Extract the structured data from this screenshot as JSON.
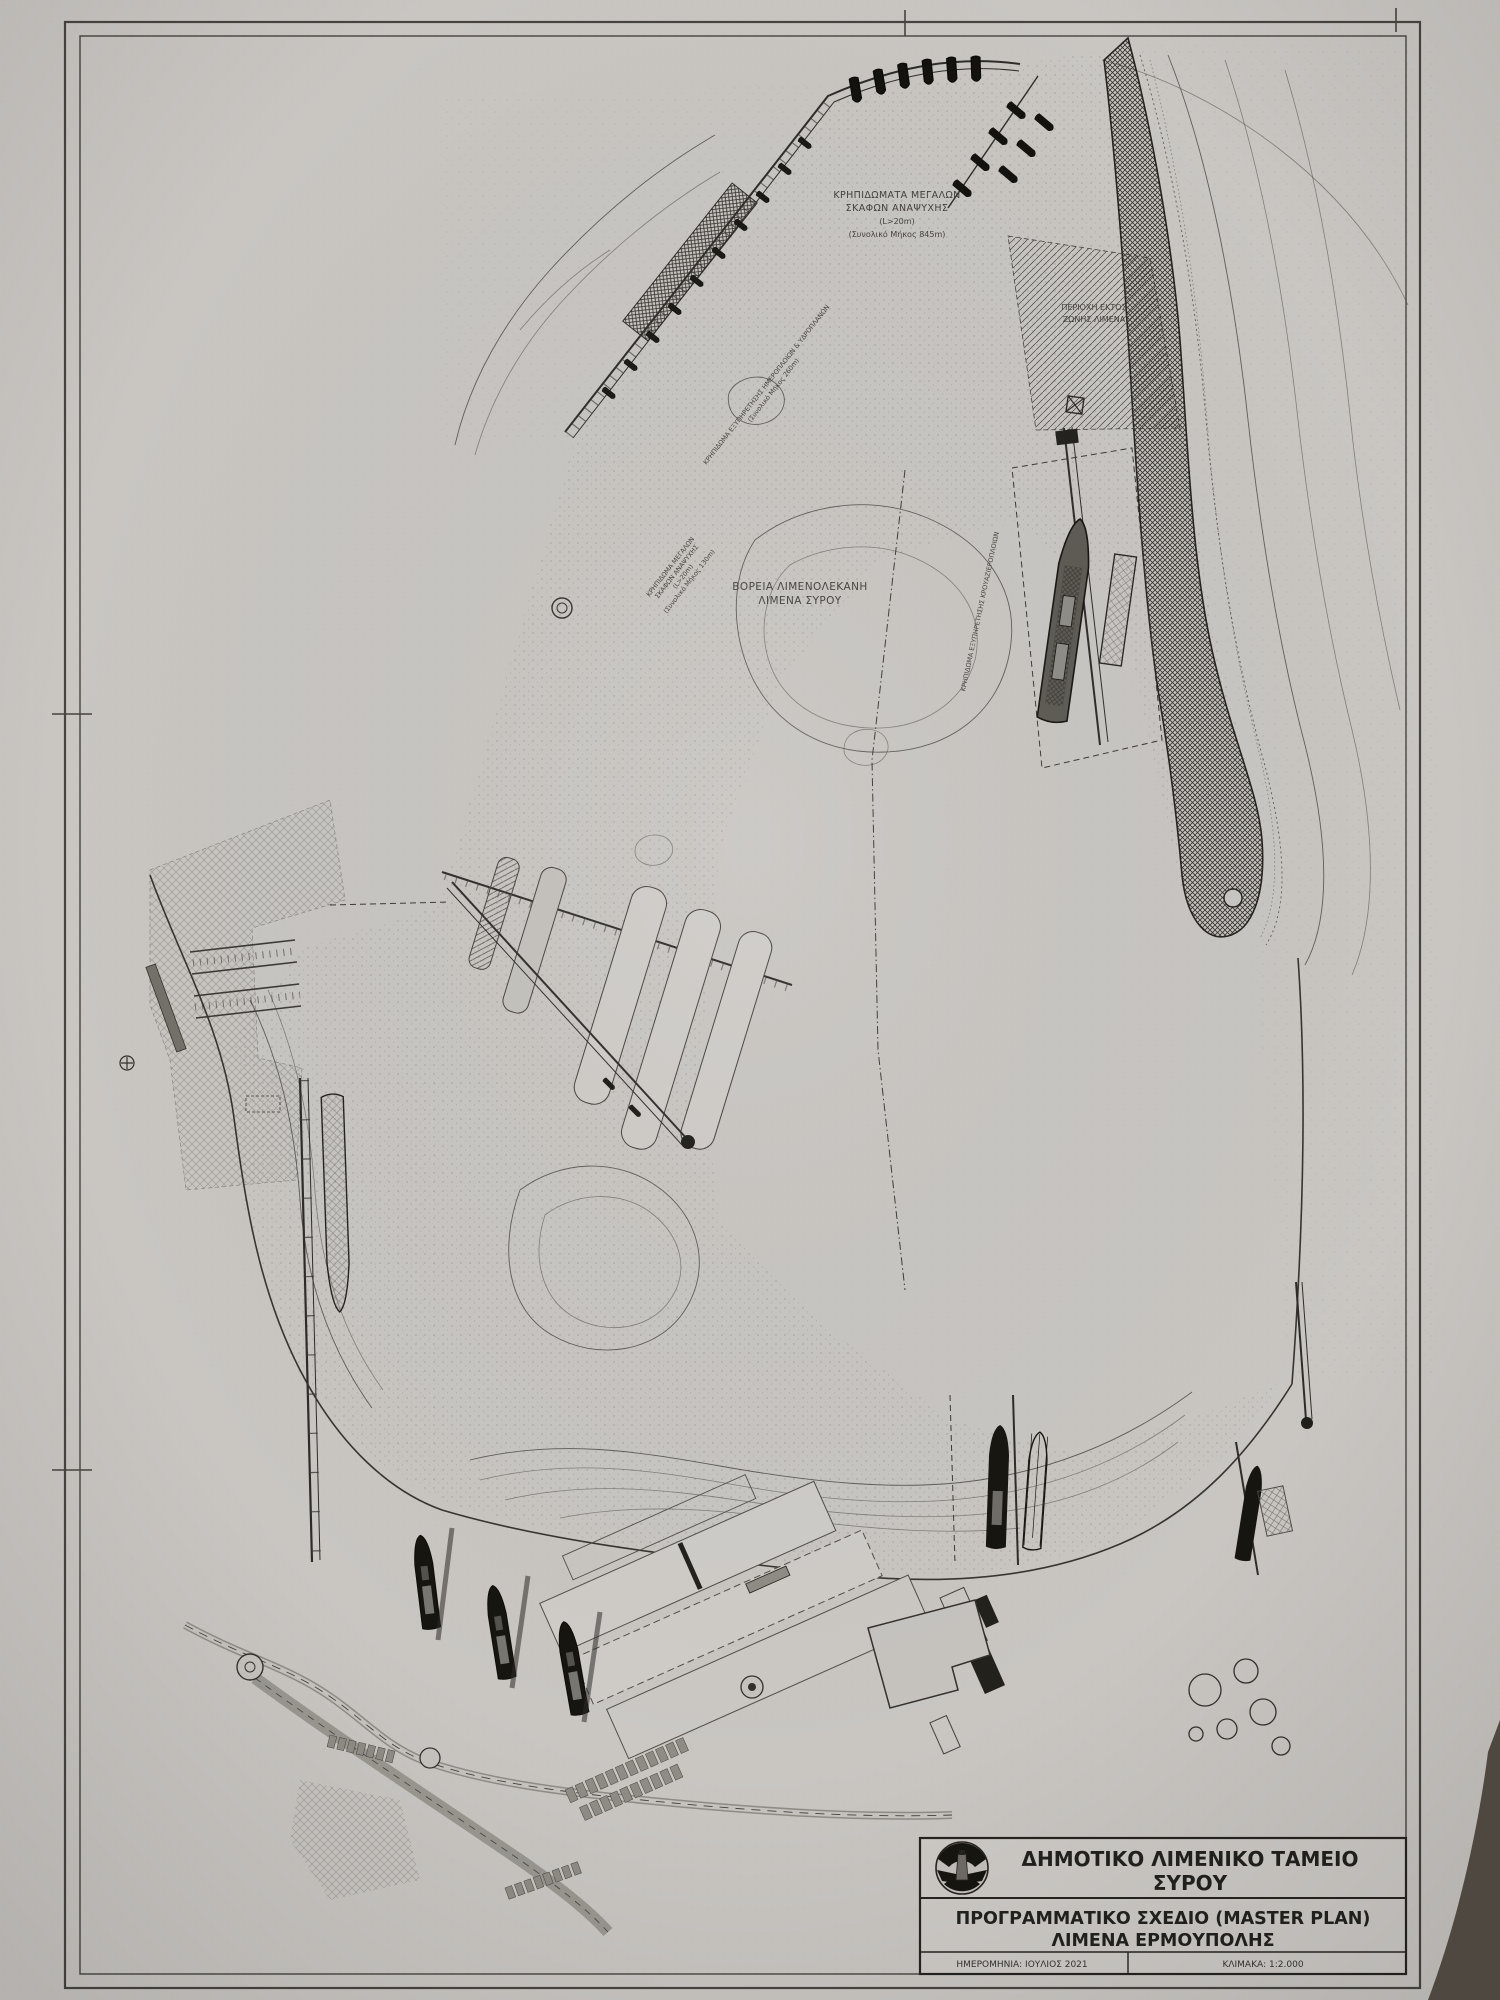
{
  "document": {
    "type": "scanned technical drawing / port master plan",
    "sheet": "photographed paper plan with double border frame"
  },
  "title_block": {
    "logo_icon": "lighthouse-emblem",
    "organization_line1": "ΔΗΜΟΤΙΚΟ ΛΙΜΕΝΙΚΟ ΤΑΜΕΙΟ",
    "organization_line2": "ΣΥΡΟΥ",
    "plan_line1": "ΠΡΟΓΡΑΜΜΑΤΙΚΟ ΣΧΕΔΙΟ  (MASTER PLAN)",
    "plan_line2": "ΛΙΜΕΝΑ ΕΡΜΟΥΠΟΛΗΣ",
    "date": "ΗΜΕΡΟΜΗΝΙΑ: ΙΟΥΛΙΟΣ 2021",
    "scale": "ΚΛΙΜΑΚΑ: 1:2.000"
  },
  "map_labels": {
    "north_quay": {
      "l1": "ΚΡΗΠΙΔΩΜΑΤΑ ΜΕΓΑΛΩΝ",
      "l2": "ΣΚΑΦΩΝ ΑΝΑΨΥΧΗΣ",
      "l3": "(L>20m)",
      "l4": "(Συνολικό Μήκος 845m)"
    },
    "outside_zone": {
      "l1": "ΠΕΡΙΟΧΗ ΕΚΤΟΣ",
      "l2": "ΖΩΝΗΣ ΛΙΜΕΝΑ"
    },
    "north_basin": {
      "l1": "ΒΟΡΕΙΑ ΛΙΜΕΝΟΛΕΚΑΝΗ",
      "l2": "ΛΙΜΕΝΑ ΣΥΡΟΥ"
    },
    "seaplane_quay": {
      "l1": "ΚΡΗΠΙΔΩΜΑ ΕΞΥΠΗΡΕΤΗΣΗΣ ΗΜΕΡΟΠΛΟΙΩΝ & ΥΔΡΟΠΛΑΝΩΝ",
      "l2": "(Συνολικό Μήκος 260m)"
    },
    "west_quay": {
      "l1": "ΚΡΗΠΙΔΩΜΑ ΜΕΓΑΛΩΝ",
      "l2": "ΣΚΑΦΩΝ ΑΝΑΨΥΧΗΣ",
      "l3": "(L>20m)",
      "l4": "(Συνολικό Μήκος 130m)"
    },
    "cruise_quay": {
      "l1": "ΚΡΗΠΙΔΩΜΑ ΕΞΥΠΗΡΕΤΗΣΗΣ ΚΡΟΥΑΖΙΕΡΟΠΛΟΙΩΝ"
    }
  },
  "colors": {
    "paper": "#c9c6c2",
    "ink": "#3c3935",
    "ship_fill": "#17150f",
    "photo_background": "#4e4841"
  }
}
